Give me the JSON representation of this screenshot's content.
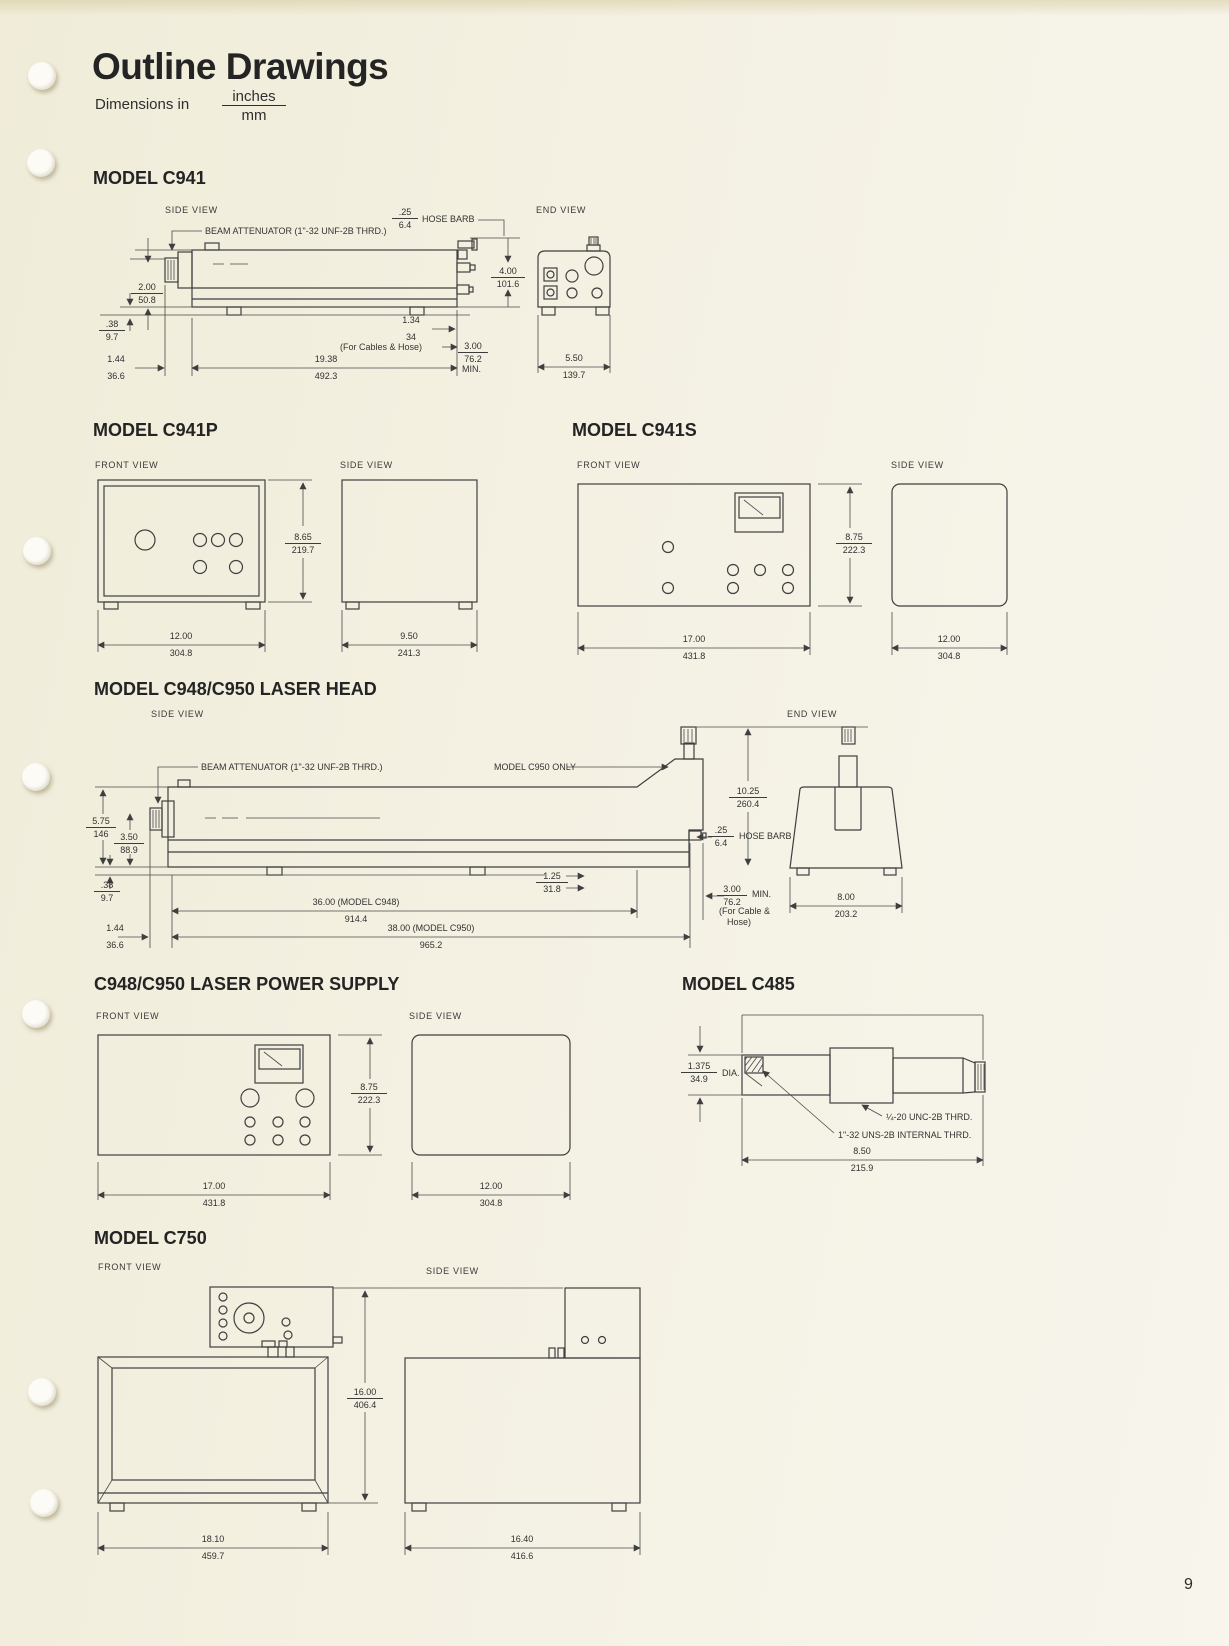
{
  "page": {
    "title": "Outline Drawings",
    "dimensions_in_label": "Dimensions in",
    "units": {
      "in": "inches",
      "mm": "mm"
    },
    "page_number": "9"
  },
  "labels": {
    "side_view": "SIDE VIEW",
    "front_view": "FRONT VIEW",
    "end_view": "END VIEW"
  },
  "c941": {
    "heading": "MODEL C941",
    "beam_attenuator": "BEAM ATTENUATOR (1\"-32 UNF-2B THRD.)",
    "hose_barb": "HOSE BARB",
    "cables_note": "(For Cables & Hose)",
    "min_note": "MIN.",
    "dims": {
      "hose_barb": {
        "in": ".25",
        "mm": "6.4"
      },
      "height": {
        "in": "2.00",
        "mm": "50.8"
      },
      "foot": {
        "in": ".38",
        "mm": "9.7"
      },
      "nose": {
        "in": "1.44",
        "mm": "36.6"
      },
      "length": {
        "in": "19.38",
        "mm": "492.3"
      },
      "rear": {
        "in": "1.34",
        "mm": "34"
      },
      "clearance": {
        "in": "3.00",
        "mm": "76.2"
      },
      "end_height": {
        "in": "4.00",
        "mm": "101.6"
      },
      "end_width": {
        "in": "5.50",
        "mm": "139.7"
      }
    }
  },
  "c941p": {
    "heading": "MODEL C941P",
    "dims": {
      "height": {
        "in": "8.65",
        "mm": "219.7"
      },
      "width": {
        "in": "12.00",
        "mm": "304.8"
      },
      "depth": {
        "in": "9.50",
        "mm": "241.3"
      }
    }
  },
  "c941s": {
    "heading": "MODEL C941S",
    "dims": {
      "height": {
        "in": "8.75",
        "mm": "222.3"
      },
      "width": {
        "in": "17.00",
        "mm": "431.8"
      },
      "depth": {
        "in": "12.00",
        "mm": "304.8"
      }
    }
  },
  "c948head": {
    "heading": "MODEL C948/C950 LASER HEAD",
    "beam_attenuator": "BEAM ATTENUATOR (1\"-32 UNF-2B THRD.)",
    "c950_only": "MODEL C950 ONLY",
    "hose_barb": "HOSE BARB",
    "min_note": "MIN.",
    "cable_note_1": "(For Cable &",
    "cable_note_2": "Hose)",
    "dims": {
      "total_height": {
        "in": "5.75",
        "mm": "146"
      },
      "body_height": {
        "in": "3.50",
        "mm": "88.9"
      },
      "foot": {
        "in": ".38",
        "mm": "9.7"
      },
      "nose": {
        "in": "1.44",
        "mm": "36.6"
      },
      "rear": {
        "in": "1.25",
        "mm": "31.8"
      },
      "length_c948": {
        "in": "36.00  (MODEL C948)",
        "mm": "914.4"
      },
      "length_c950": {
        "in": "38.00  (MODEL C950)",
        "mm": "965.2"
      },
      "knob_height": {
        "in": "10.25",
        "mm": "260.4"
      },
      "hose_barb": {
        "in": ".25",
        "mm": "6.4"
      },
      "clearance": {
        "in": "3.00",
        "mm": "76.2"
      },
      "end_width": {
        "in": "8.00",
        "mm": "203.2"
      }
    }
  },
  "c948ps": {
    "heading": "C948/C950 LASER POWER SUPPLY",
    "dims": {
      "height": {
        "in": "8.75",
        "mm": "222.3"
      },
      "width": {
        "in": "17.00",
        "mm": "431.8"
      },
      "depth": {
        "in": "12.00",
        "mm": "304.8"
      }
    }
  },
  "c485": {
    "heading": "MODEL C485",
    "dia_note": "DIA.",
    "thread_1": "¼-20 UNC-2B THRD.",
    "thread_2": "1\"-32 UNS-2B INTERNAL THRD.",
    "dims": {
      "dia": {
        "in": "1.375",
        "mm": "34.9"
      },
      "length": {
        "in": "8.50",
        "mm": "215.9"
      }
    }
  },
  "c750": {
    "heading": "MODEL C750",
    "dims": {
      "height": {
        "in": "16.00",
        "mm": "406.4"
      },
      "width": {
        "in": "18.10",
        "mm": "459.7"
      },
      "depth": {
        "in": "16.40",
        "mm": "416.6"
      }
    }
  }
}
